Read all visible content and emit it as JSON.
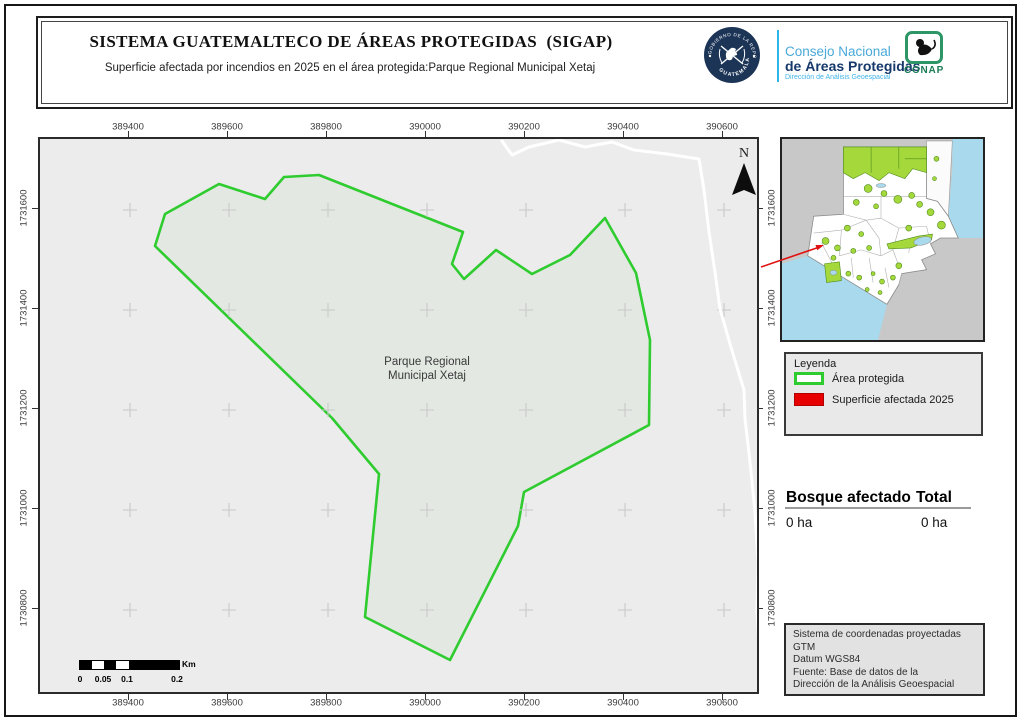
{
  "header": {
    "title": "SISTEMA GUATEMALTECO DE ÁREAS PROTEGIDAS  (SIGAP)",
    "subtitle": "Superficie afectada por incendios en 2025 en el área protegida:Parque Regional Municipal Xetaj",
    "seal_text_top": "GOBIERNO DE LA REPÚBLICA",
    "seal_text_bottom": "GUATEMALA",
    "org_line1": "Consejo Nacional",
    "org_line2": "de Áreas Protegidas",
    "org_line3": "Dirección de Análisis Geoespacial",
    "conap_label": "CONAP"
  },
  "map": {
    "x_ticks": [
      "389400",
      "389600",
      "389800",
      "390000",
      "390200",
      "390400",
      "390600"
    ],
    "y_ticks": [
      "1731600",
      "1731400",
      "1731200",
      "1731000",
      "1730800"
    ],
    "park_label_line1": "Parque Regional",
    "park_label_line2": "Municipal Xetaj",
    "north_label": "N",
    "colors": {
      "protected_border": "#2fcc2f",
      "protected_fill": "#e3e8e2",
      "map_background": "#ececec",
      "affected": "#e60000",
      "inset_protected": "#a5d83a",
      "water": "#a9d9ec"
    }
  },
  "scalebar": {
    "labels": [
      "0",
      "0.05",
      "0.1",
      "0.2"
    ],
    "unit": "Km"
  },
  "legend": {
    "title": "Leyenda",
    "items": [
      {
        "label": "Área protegida"
      },
      {
        "label": "Superficie afectada 2025"
      }
    ]
  },
  "stats": {
    "col1_header": "Bosque afectado",
    "col2_header": "Total",
    "col1_value": "0 ha",
    "col2_value": "0 ha"
  },
  "info_box": {
    "lines": [
      "Sistema de coordenadas proyectadas",
      "GTM",
      "Datum WGS84",
      "Fuente: Base de datos de la",
      "Dirección de la Análisis Geoespacial"
    ]
  }
}
